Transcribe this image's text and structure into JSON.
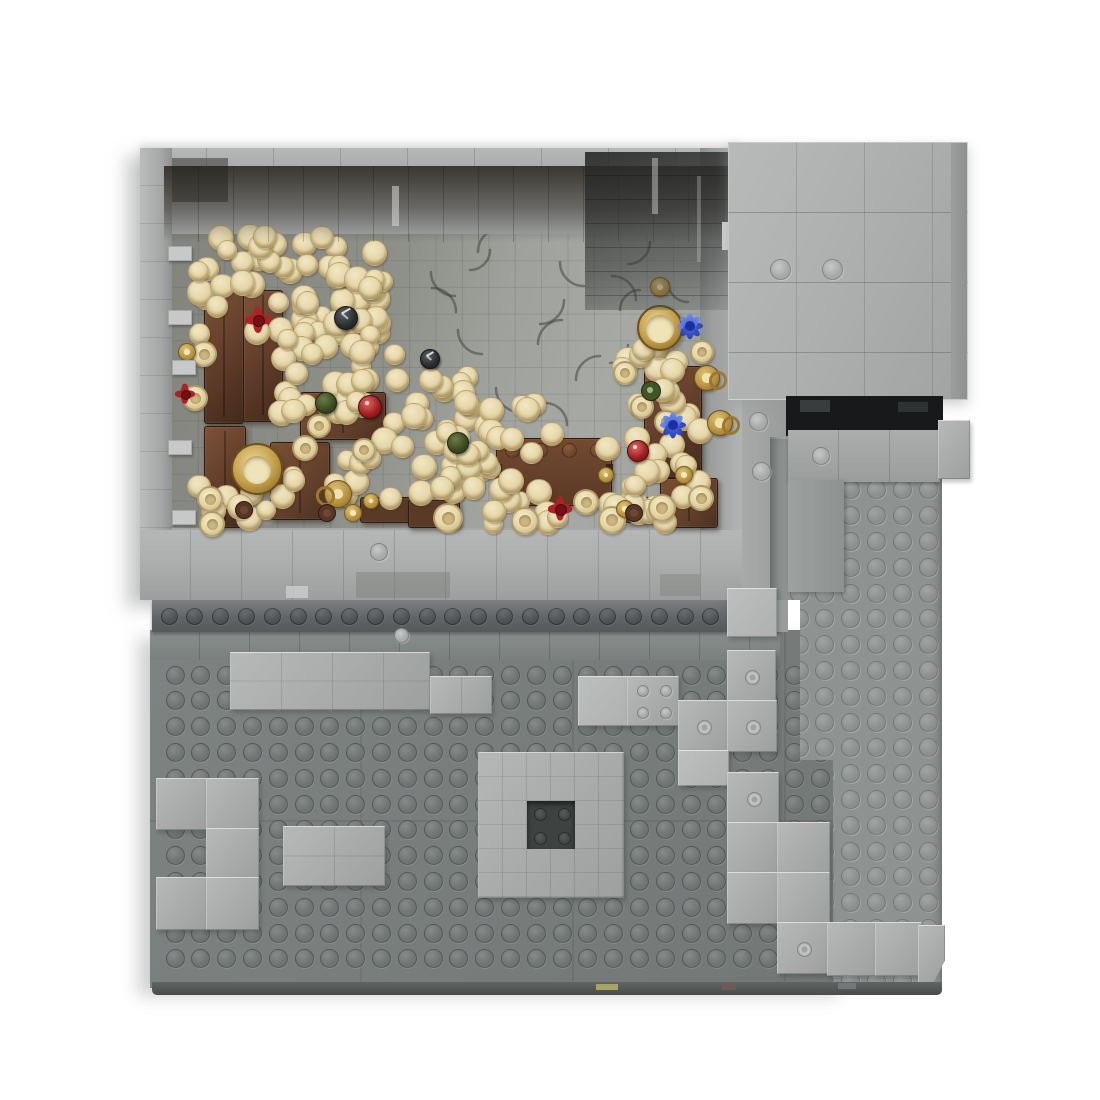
{
  "scene": {
    "label": "Top-down 3D render of a gray LEGO MOC stone dungeon module: an enclosed treasure-tavern room filled with piles of gold coins, wooden cabinets, an open chest, goblets and colored gems, built on a studded gray baseplate with scattered light-gray bricks and a raised side platform",
    "background": "#ffffff"
  },
  "palette": {
    "bg": "#ffffff",
    "wall": "#a6a9a8",
    "lightBrick": "#a9acab",
    "lightHi": "#c9ccca",
    "base": "#7a7f7e",
    "baseStud": "#6f7473",
    "row": "#5d6164",
    "plat": "#8e9392",
    "platStud": "#9ca19f",
    "door": "#17191a",
    "ceiling": "#39352e",
    "floorA": "#84867f",
    "floorB": "#a7a9a5",
    "coin": "#e4d5a7",
    "coinHi": "#f2e7c2",
    "coinShadow": "#ab9159",
    "brown": "#5f3c2a",
    "brownHi": "#7d5238",
    "brownDark": "#432a1b",
    "gold": "#c7a24c",
    "goldDark": "#8a682a",
    "tan": "#ead9a9",
    "red": "#a31f24",
    "blue": "#3a50cf",
    "green": "#46542c",
    "black": "#26282b"
  },
  "studGrids": [
    {
      "name": "baseplate-stud",
      "cx": 174,
      "cy": 674,
      "cols": 26,
      "rows": 12,
      "pitch": 25.8,
      "d": 17,
      "kind": "dark",
      "z": 11
    },
    {
      "name": "row-stud",
      "cx": 168,
      "cy": 615,
      "cols": 24,
      "rows": 1,
      "pitch": 25.8,
      "d": 15,
      "kind": "row",
      "z": 13
    }
  ],
  "platformStuds": {
    "cx": 28,
    "cy": 26,
    "cols": 6,
    "rows": 21,
    "pitch": 25.8,
    "d": 17
  },
  "coinClusters": [
    {
      "x": 192,
      "y": 236,
      "w": 190,
      "h": 98,
      "n": 58
    },
    {
      "x": 280,
      "y": 332,
      "w": 120,
      "h": 92,
      "n": 26
    },
    {
      "x": 330,
      "y": 372,
      "w": 150,
      "h": 126,
      "n": 40
    },
    {
      "x": 438,
      "y": 402,
      "w": 115,
      "h": 100,
      "n": 26
    },
    {
      "x": 605,
      "y": 412,
      "w": 95,
      "h": 100,
      "n": 20
    },
    {
      "x": 620,
      "y": 340,
      "w": 76,
      "h": 72,
      "n": 12
    },
    {
      "x": 190,
      "y": 468,
      "w": 112,
      "h": 52,
      "n": 10
    },
    {
      "x": 425,
      "y": 483,
      "w": 250,
      "h": 42,
      "n": 14
    }
  ],
  "furniture": [
    {
      "k": "cabinet",
      "x": 204,
      "y": 286,
      "w": 38,
      "h": 136
    },
    {
      "k": "cabinet",
      "x": 243,
      "y": 290,
      "w": 38,
      "h": 130
    },
    {
      "k": "cabinet",
      "x": 204,
      "y": 426,
      "w": 40,
      "h": 100
    },
    {
      "k": "table",
      "x": 270,
      "y": 442,
      "w": 58,
      "h": 76
    },
    {
      "k": "table",
      "x": 300,
      "y": 392,
      "w": 84,
      "h": 46
    },
    {
      "k": "chest",
      "x": 496,
      "y": 438,
      "w": 114,
      "h": 66
    },
    {
      "k": "cabinet",
      "x": 644,
      "y": 366,
      "w": 56,
      "h": 110
    },
    {
      "k": "table",
      "x": 660,
      "y": 478,
      "w": 56,
      "h": 48
    },
    {
      "k": "bench",
      "x": 360,
      "y": 497,
      "w": 50,
      "h": 24
    },
    {
      "k": "bench",
      "x": 408,
      "y": 500,
      "w": 50,
      "h": 26
    },
    {
      "k": "bench",
      "x": 625,
      "y": 497,
      "w": 40,
      "h": 24
    }
  ],
  "props": [
    {
      "t": "chalice-gold",
      "x": 255,
      "y": 467,
      "r": 24
    },
    {
      "t": "dish-gold",
      "x": 658,
      "y": 326,
      "r": 21
    },
    {
      "t": "mug-gold",
      "x": 337,
      "y": 493,
      "r": 13
    },
    {
      "t": "jug-gold",
      "x": 706,
      "y": 377,
      "r": 12
    },
    {
      "t": "jug-gold",
      "x": 719,
      "y": 422,
      "r": 12
    },
    {
      "t": "goblet-tan",
      "x": 202,
      "y": 352,
      "r": 11
    },
    {
      "t": "goblet-tan",
      "x": 193,
      "y": 396,
      "r": 11
    },
    {
      "t": "goblet-tan",
      "x": 208,
      "y": 497,
      "r": 11
    },
    {
      "t": "goblet-tan",
      "x": 210,
      "y": 522,
      "r": 11
    },
    {
      "t": "goblet-tan",
      "x": 317,
      "y": 424,
      "r": 10
    },
    {
      "t": "goblet-tan",
      "x": 303,
      "y": 446,
      "r": 11
    },
    {
      "t": "goblet-tan",
      "x": 362,
      "y": 448,
      "r": 10
    },
    {
      "t": "goblet-tan",
      "x": 446,
      "y": 516,
      "r": 13
    },
    {
      "t": "goblet-tan",
      "x": 523,
      "y": 519,
      "r": 12
    },
    {
      "t": "goblet-tan",
      "x": 610,
      "y": 518,
      "r": 12
    },
    {
      "t": "goblet-tan",
      "x": 660,
      "y": 506,
      "r": 12
    },
    {
      "t": "goblet-tan",
      "x": 699,
      "y": 496,
      "r": 11
    },
    {
      "t": "goblet-tan",
      "x": 664,
      "y": 420,
      "r": 10
    },
    {
      "t": "goblet-tan",
      "x": 700,
      "y": 350,
      "r": 10
    },
    {
      "t": "goblet-tan",
      "x": 640,
      "y": 405,
      "r": 10
    },
    {
      "t": "goblet-tan",
      "x": 623,
      "y": 371,
      "r": 10
    },
    {
      "t": "goblet-tan",
      "x": 584,
      "y": 500,
      "r": 11
    },
    {
      "t": "bottle-gold",
      "x": 186,
      "y": 351,
      "r": 8
    },
    {
      "t": "bottle-gold",
      "x": 352,
      "y": 512,
      "r": 8
    },
    {
      "t": "bottle-gold",
      "x": 370,
      "y": 500,
      "r": 7
    },
    {
      "t": "bottle-gold",
      "x": 605,
      "y": 474,
      "r": 7
    },
    {
      "t": "bottle-gold",
      "x": 624,
      "y": 508,
      "r": 8
    },
    {
      "t": "bottle-gold",
      "x": 683,
      "y": 474,
      "r": 8
    },
    {
      "t": "bottle-gold",
      "x": 659,
      "y": 286,
      "r": 9
    },
    {
      "t": "gem-red",
      "x": 369,
      "y": 406,
      "r": 11
    },
    {
      "t": "gem-red",
      "x": 637,
      "y": 450,
      "r": 10
    },
    {
      "t": "flower-red",
      "x": 258,
      "y": 320,
      "r": 13
    },
    {
      "t": "flower-red",
      "x": 560,
      "y": 509,
      "r": 12
    },
    {
      "t": "flower-red",
      "x": 185,
      "y": 394,
      "r": 10
    },
    {
      "t": "gem-blue",
      "x": 690,
      "y": 326,
      "r": 13
    },
    {
      "t": "gem-blue",
      "x": 673,
      "y": 425,
      "r": 13
    },
    {
      "t": "gem-green",
      "x": 325,
      "y": 402,
      "r": 10
    },
    {
      "t": "gem-green",
      "x": 457,
      "y": 442,
      "r": 10
    },
    {
      "t": "bottle-green",
      "x": 650,
      "y": 390,
      "r": 9
    },
    {
      "t": "gem-black",
      "x": 345,
      "y": 317,
      "r": 11
    },
    {
      "t": "gem-black",
      "x": 429,
      "y": 358,
      "r": 9
    },
    {
      "t": "mug-brown",
      "x": 243,
      "y": 509,
      "r": 8
    },
    {
      "t": "mug-brown",
      "x": 326,
      "y": 512,
      "r": 8
    },
    {
      "t": "mug-brown",
      "x": 633,
      "y": 512,
      "r": 8
    }
  ],
  "bricks": [
    {
      "k": "slab",
      "x": 230,
      "y": 652,
      "w": 198,
      "h": 56,
      "seams": 3
    },
    {
      "k": "slab",
      "x": 430,
      "y": 676,
      "w": 60,
      "h": 36,
      "seams": 1
    },
    {
      "k": "tile",
      "x": 578,
      "y": 676,
      "w": 49,
      "h": 48
    },
    {
      "k": "plate4",
      "x": 627,
      "y": 676,
      "w": 50,
      "h": 48
    },
    {
      "k": "jumper",
      "x": 727,
      "y": 650,
      "w": 47,
      "h": 50
    },
    {
      "k": "jumper",
      "x": 678,
      "y": 700,
      "w": 49,
      "h": 50
    },
    {
      "k": "jumper",
      "x": 727,
      "y": 700,
      "w": 48,
      "h": 50
    },
    {
      "k": "tile",
      "x": 678,
      "y": 750,
      "w": 49,
      "h": 34
    },
    {
      "k": "tile",
      "x": 727,
      "y": 588,
      "w": 48,
      "h": 47
    },
    {
      "k": "brick",
      "x": 156,
      "y": 778,
      "w": 50,
      "h": 50
    },
    {
      "k": "brick",
      "x": 206,
      "y": 778,
      "w": 51,
      "h": 50
    },
    {
      "k": "brick",
      "x": 206,
      "y": 828,
      "w": 51,
      "h": 49
    },
    {
      "k": "brick",
      "x": 156,
      "y": 877,
      "w": 50,
      "h": 51
    },
    {
      "k": "brick",
      "x": 206,
      "y": 877,
      "w": 51,
      "h": 51
    },
    {
      "k": "slab",
      "x": 283,
      "y": 826,
      "w": 100,
      "h": 58,
      "seams": 1
    },
    {
      "k": "jumper",
      "x": 727,
      "y": 772,
      "w": 50,
      "h": 50
    },
    {
      "k": "brick",
      "x": 727,
      "y": 822,
      "w": 50,
      "h": 50
    },
    {
      "k": "brick",
      "x": 777,
      "y": 822,
      "w": 51,
      "h": 50
    },
    {
      "k": "brick",
      "x": 727,
      "y": 872,
      "w": 50,
      "h": 50
    },
    {
      "k": "brick",
      "x": 777,
      "y": 872,
      "w": 51,
      "h": 50
    },
    {
      "k": "jumper",
      "x": 777,
      "y": 922,
      "w": 50,
      "h": 50
    },
    {
      "k": "brick",
      "x": 827,
      "y": 922,
      "w": 48,
      "h": 52
    },
    {
      "k": "brick",
      "x": 875,
      "y": 922,
      "w": 45,
      "h": 52
    },
    {
      "k": "corner",
      "x": 918,
      "y": 925,
      "w": 25,
      "h": 57
    },
    {
      "k": "brick",
      "x": 938,
      "y": 420,
      "w": 30,
      "h": 57
    }
  ],
  "donut": {
    "x": 478,
    "y": 752,
    "cell": 24,
    "cols": 6,
    "rows": 6,
    "holeCol": 2,
    "holeRow": 2,
    "holeSpan": 2
  },
  "ledges": [
    {
      "x": 168,
      "y": 246
    },
    {
      "x": 168,
      "y": 310
    },
    {
      "x": 172,
      "y": 360
    },
    {
      "x": 168,
      "y": 440
    },
    {
      "x": 172,
      "y": 510
    }
  ],
  "patches": [
    {
      "n": "glass-sliver",
      "x": 652,
      "y": 158,
      "w": 6,
      "h": 56,
      "c": "rgba(215,217,215,0.45)",
      "z": 29
    },
    {
      "n": "glass-sliver",
      "x": 697,
      "y": 176,
      "w": 4,
      "h": 86,
      "c": "rgba(205,207,205,0.3)",
      "z": 29
    },
    {
      "n": "wall-slit",
      "x": 722,
      "y": 222,
      "w": 8,
      "h": 28,
      "c": "#ced1d0",
      "z": 29
    },
    {
      "n": "reflection",
      "x": 392,
      "y": 186,
      "w": 7,
      "h": 40,
      "c": "rgba(225,227,225,0.5)",
      "z": 29
    },
    {
      "n": "wall-tile",
      "x": 286,
      "y": 586,
      "w": 22,
      "h": 12,
      "c": "#c2c5c4",
      "z": 24
    },
    {
      "n": "wall-texture",
      "x": 356,
      "y": 572,
      "w": 94,
      "h": 26,
      "c": "rgba(125,127,123,0.45)",
      "z": 24
    },
    {
      "n": "wall-texture",
      "x": 660,
      "y": 574,
      "w": 40,
      "h": 22,
      "c": "rgba(125,127,123,0.4)",
      "z": 24
    },
    {
      "n": "doorway-lintel",
      "x": 800,
      "y": 400,
      "w": 30,
      "h": 12,
      "c": "#3a3d3e",
      "z": 33
    },
    {
      "n": "doorway-lintel",
      "x": 898,
      "y": 402,
      "w": 30,
      "h": 10,
      "c": "#2f3233",
      "z": 33
    },
    {
      "n": "corner-shadow",
      "x": 172,
      "y": 158,
      "w": 56,
      "h": 44,
      "c": "rgba(35,33,29,0.45)",
      "z": 28
    }
  ],
  "studDots": [
    {
      "x": 779,
      "y": 268,
      "d": 19
    },
    {
      "x": 831,
      "y": 268,
      "d": 19
    },
    {
      "x": 757,
      "y": 420,
      "d": 17
    },
    {
      "x": 760,
      "y": 470,
      "d": 17
    },
    {
      "x": 820,
      "y": 455,
      "d": 16
    },
    {
      "x": 378,
      "y": 551,
      "d": 16
    },
    {
      "x": 400,
      "y": 634,
      "d": 13
    }
  ],
  "floorArcs": [
    [
      455,
      272,
      24,
      90
    ],
    [
      502,
      252,
      24,
      180
    ],
    [
      540,
      300,
      24,
      0
    ],
    [
      584,
      262,
      24,
      90
    ],
    [
      612,
      300,
      24,
      270
    ],
    [
      562,
      344,
      24,
      180
    ],
    [
      482,
      330,
      24,
      90
    ],
    [
      628,
      242,
      22,
      0
    ],
    [
      658,
      348,
      24,
      90
    ],
    [
      600,
      380,
      24,
      180
    ],
    [
      432,
      312,
      24,
      270
    ],
    [
      520,
      388,
      24,
      90
    ],
    [
      470,
      250,
      20,
      0
    ],
    [
      640,
      310,
      20,
      180
    ],
    [
      688,
      282,
      20,
      90
    ],
    [
      610,
      345,
      18,
      0
    ],
    [
      545,
      425,
      22,
      270
    ],
    [
      480,
      430,
      20,
      180
    ]
  ],
  "edgeFlecks": [
    {
      "x": 596,
      "y": 984,
      "w": 22,
      "h": 6,
      "c": "#a8a468"
    },
    {
      "x": 722,
      "y": 984,
      "w": 14,
      "h": 6,
      "c": "#6e5a52"
    },
    {
      "x": 838,
      "y": 983,
      "w": 18,
      "h": 6,
      "c": "#74787a"
    }
  ]
}
